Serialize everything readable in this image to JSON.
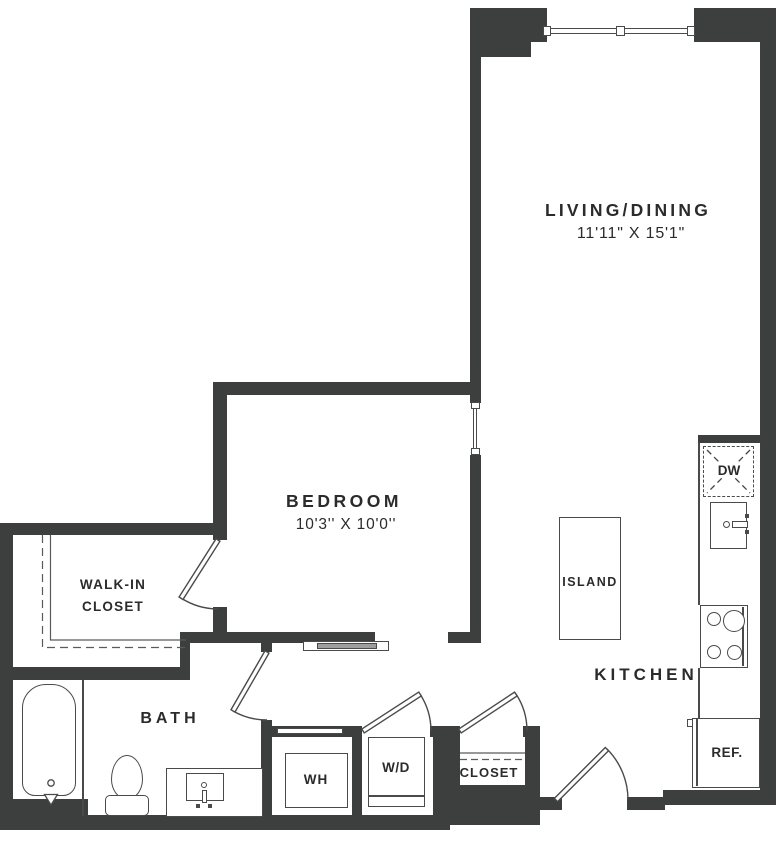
{
  "labels": {
    "living_name": "LIVING/DINING",
    "living_dims": "11'11\" X 15'1\"",
    "bedroom_name": "BEDROOM",
    "bedroom_dims": "10'3'' X 10'0''",
    "walkin_line1": "WALK-IN",
    "walkin_line2": "CLOSET",
    "bath": "BATH",
    "kitchen": "KITCHEN",
    "island": "ISLAND",
    "water_heater": "WH",
    "washer_dryer": "W/D",
    "closet": "CLOSET",
    "refrigerator": "REF.",
    "dishwasher": "DW"
  },
  "colors": {
    "wall": "#3d3f3f",
    "line": "#4a4a4a",
    "text": "#2b2b2b",
    "door_panel": "#9e9e9e",
    "background": "#ffffff"
  }
}
